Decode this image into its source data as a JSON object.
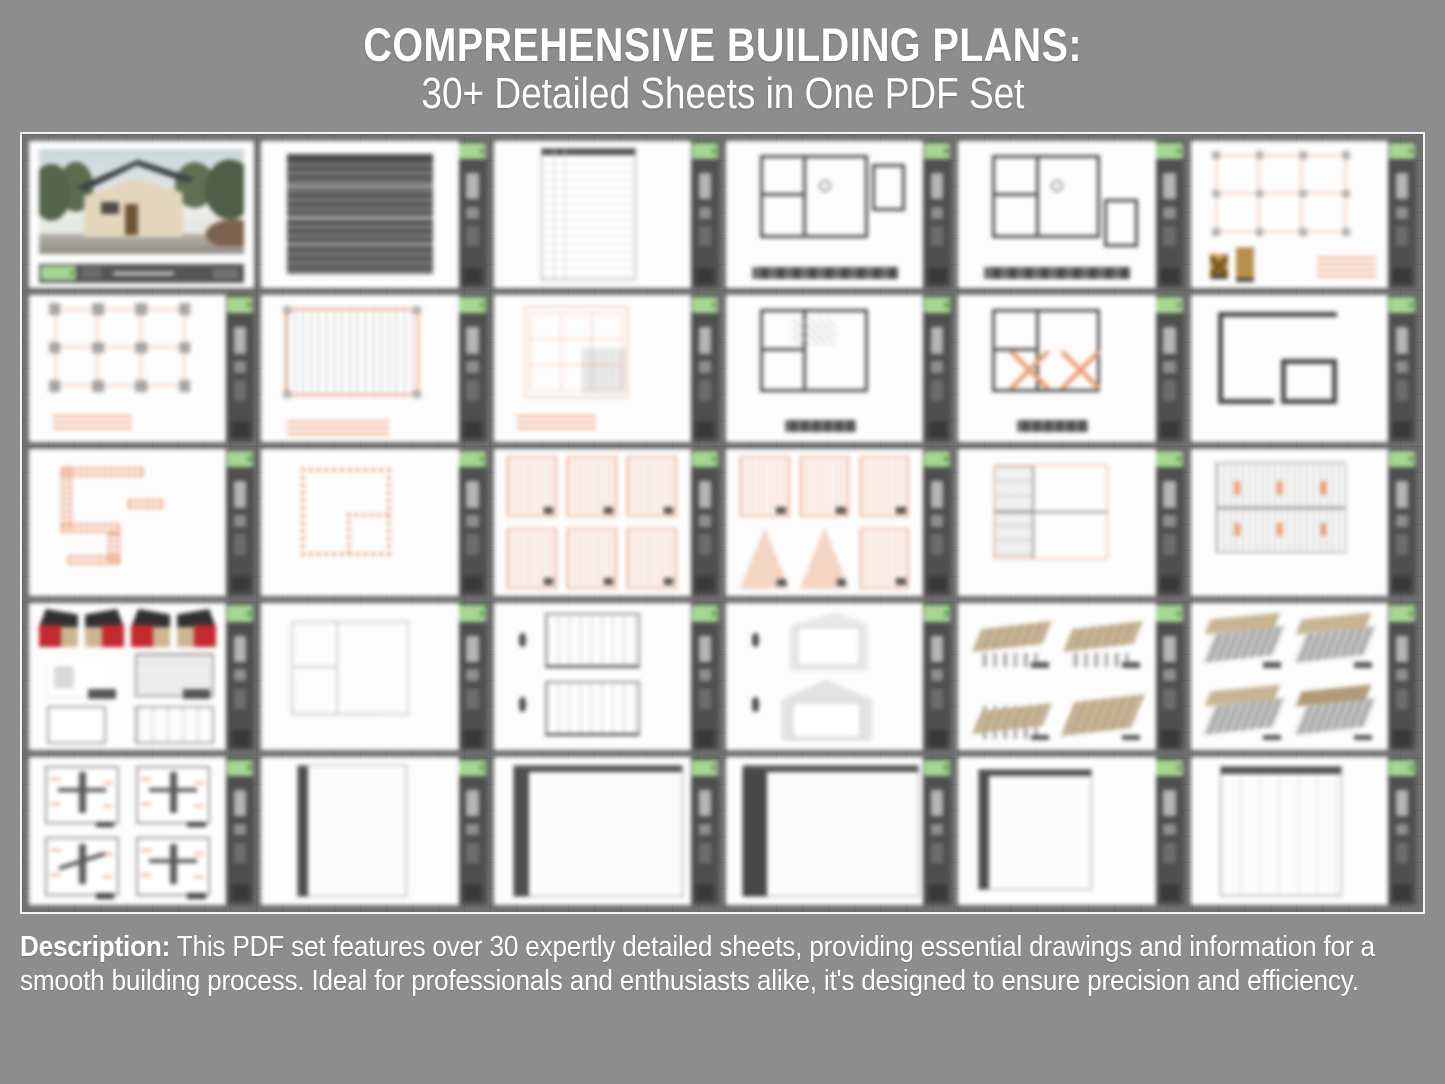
{
  "header": {
    "line1": "COMPREHENSIVE BUILDING PLANS:",
    "line2": "30+ Detailed Sheets in One PDF Set"
  },
  "description": {
    "label": "Description:",
    "text": " This PDF set features over 30 expertly detailed sheets, providing essential drawings and information for a smooth building process. Ideal for professionals and enthusiasts alike, it's designed to ensure precision and efficiency."
  },
  "colors": {
    "page_bg": "#8d8d8d",
    "panel_bg": "#707070",
    "frame_border": "#f2f2f2",
    "sheet_white": "#fdfdfd",
    "titleblock_gray": "#4f4f4f",
    "tab_green": "#a5d793",
    "qr_dark": "#262626",
    "drawing_orange": "#eb9e77",
    "drawing_dark": "#4a4a4a",
    "barn_red": "#c3292d",
    "wood_tan": "#c7b493",
    "text_white": "#ffffff"
  },
  "grid": {
    "columns": 6,
    "rows": 5,
    "sheet_count": 30
  },
  "thumbnails": [
    {
      "kind": "cover"
    },
    {
      "kind": "textdoc"
    },
    {
      "kind": "index"
    },
    {
      "kind": "plan-legend",
      "variant": "a"
    },
    {
      "kind": "plan-legend",
      "variant": "b"
    },
    {
      "kind": "orange-grid-found"
    },
    {
      "kind": "orange-grid-piles"
    },
    {
      "kind": "joist-vert"
    },
    {
      "kind": "framing-plan"
    },
    {
      "kind": "plan-hatch"
    },
    {
      "kind": "plan-x"
    },
    {
      "kind": "wall-outline"
    },
    {
      "kind": "wall-orange"
    },
    {
      "kind": "wall-orange-rect"
    },
    {
      "kind": "panels"
    },
    {
      "kind": "panels-gable"
    },
    {
      "kind": "ceiling-grid"
    },
    {
      "kind": "joist-horiz"
    },
    {
      "kind": "barns"
    },
    {
      "kind": "light-plan"
    },
    {
      "kind": "sections-two"
    },
    {
      "kind": "sections-gable"
    },
    {
      "kind": "iso-floor"
    },
    {
      "kind": "iso-walls"
    },
    {
      "kind": "details-four"
    },
    {
      "kind": "spec-a"
    },
    {
      "kind": "spec-b"
    },
    {
      "kind": "spec-c"
    },
    {
      "kind": "spec-d"
    },
    {
      "kind": "spec-e"
    }
  ]
}
